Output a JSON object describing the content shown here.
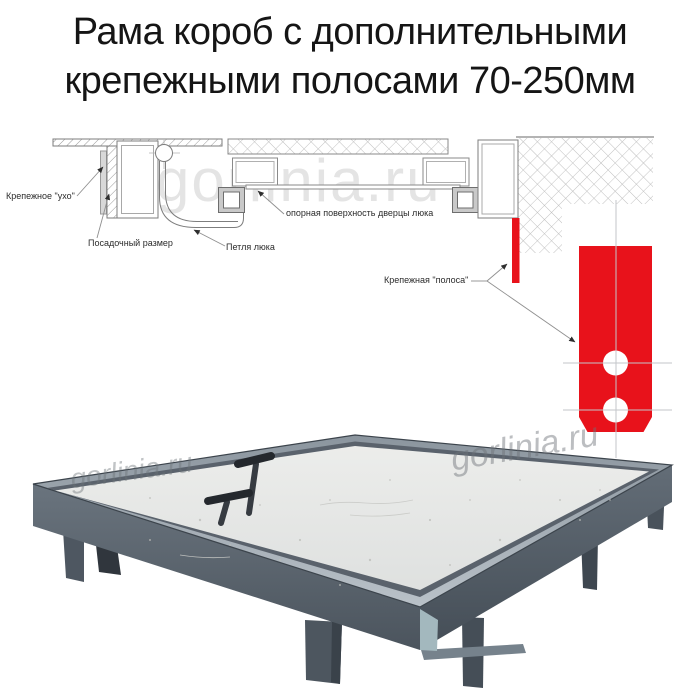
{
  "title": {
    "line1": "Рама короб с дополнительными",
    "line2": "крепежными полосами 70-250мм"
  },
  "watermark": {
    "text": "gorlinia.ru"
  },
  "diagram": {
    "labels": {
      "mounting_ear": "Крепежное \"ухо\"",
      "seating_size": "Посадочный размер",
      "hatch_hinge": "Петля люка",
      "door_support_surface": "опорная поверхность дверцы люка",
      "mounting_strip": "Крепежная \"полоса\""
    },
    "colors": {
      "strip_red": "#e8121b",
      "linework": "#7d7d7d",
      "hatch": "#b5b5b5",
      "centerline": "#c3c6ca"
    }
  },
  "photo": {
    "colors": {
      "frame_side_left": "#5d6872",
      "frame_side_right": "#525c66",
      "frame_rim": "#aab3bb",
      "door_panel": "#e9eae8",
      "mounting_leg": "#49525b",
      "handle": "#2c3136"
    }
  }
}
